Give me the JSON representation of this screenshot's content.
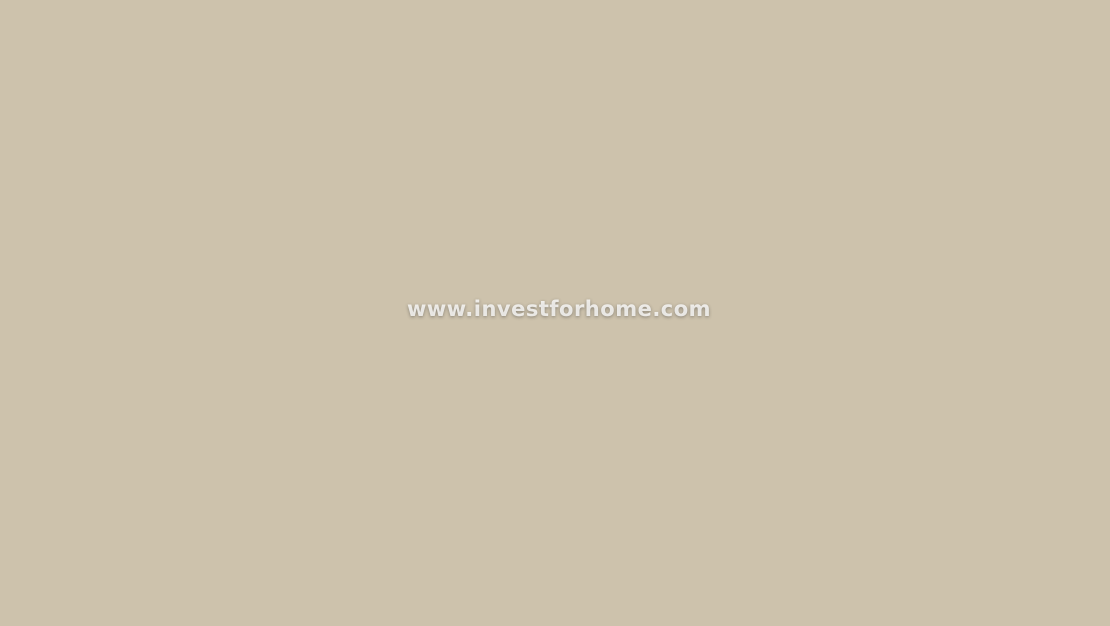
{
  "watermark": {
    "text": "www.investforhome.com"
  },
  "palette": {
    "town_ground": "#cdc2ac",
    "house_wall": "#f7f4ec",
    "house_wall_alt": "#e9e1d1",
    "roof_terracotta": "#b15c32",
    "roof_terracotta_light": "#c97c49",
    "roof_white": "#efede4",
    "tree_green": "#3c6a2c",
    "tree_dark": "#2d5423",
    "palm_green": "#3e7d33",
    "road_gray": "#a8a6a0",
    "road_light": "#b6b4ac",
    "asphalt_dark": "#898d92",
    "avenue_gray": "#a49e93",
    "sidewalk_brick": "#b05a3d",
    "marking_white": "#ffffff",
    "scrub_base": "#9a9a6e",
    "scrub_dark": "#6e7a49",
    "scrub_tan": "#c7b489",
    "orchard_tan": "#b4a478",
    "field_green": "#7ba344",
    "field_green_dark": "#6e9c3e",
    "field_dirt": "#75613c",
    "dev_ground": "#abb076",
    "lawn_bright": "#4aa63a",
    "lawn_mid": "#8eb054",
    "pool_water": "#44c5de",
    "pool_water_light": "#8fdff0",
    "deck_white": "#efece0",
    "building_white": "#f6f5f0",
    "building_shade": "#dfddd3",
    "solar_panel": "#47586c",
    "wall_white": "#f8f8f3",
    "hedge_green": "#3b8a3c",
    "car_dark": "#2c3137",
    "car_gray": "#70757a",
    "car_white": "#edeff1",
    "car_red": "#c23a2d",
    "orange_roof": "#cf7f3a",
    "orange_accent": "#e19b42",
    "villa_roof": "#8a5a33",
    "water_teal": "#3e8f8b",
    "shadow": "rgba(40,45,25,0.32)"
  }
}
